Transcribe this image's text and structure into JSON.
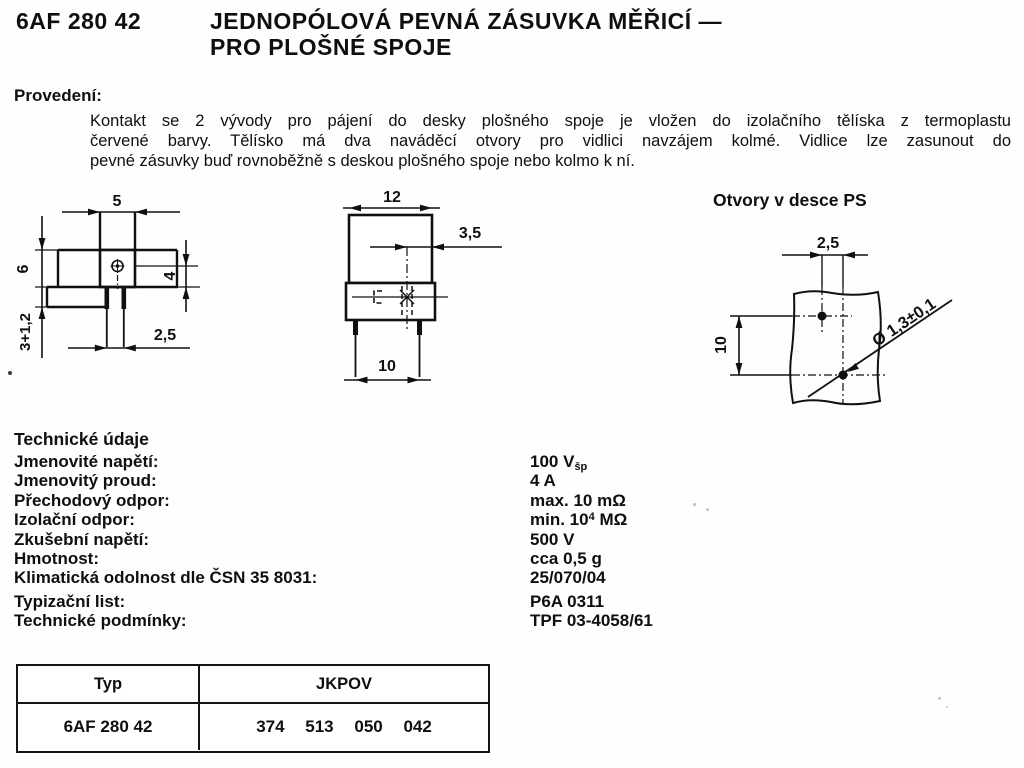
{
  "header": {
    "code": "6AF 280 42",
    "title_line1": "JEDNOPÓLOVÁ PEVNÁ ZÁSUVKA MĚŘICÍ —",
    "title_line2": "PRO PLOŠNÉ SPOJE"
  },
  "provedeni": {
    "heading": "Provedení:",
    "lines": [
      "Kontakt se 2 vývody pro pájení do desky plošného spoje je vložen do izolačního tělíska z termoplastu",
      "červené barvy. Tělísko má dva naváděcí otvory pro vidlici navzájem kolmé. Vidlice lze zasunout do",
      "pevné zásuvky buď rovnoběžně s deskou plošného spoje nebo kolmo k ní."
    ]
  },
  "drawings": {
    "front": {
      "dim_width_top": "5",
      "dim_height": "6",
      "dim_pin_length": "3+1,2",
      "dim_hole_to_base": "4",
      "dim_pin_spacing": "2,5"
    },
    "side": {
      "dim_width": "12",
      "dim_center_to_edge": "3,5",
      "dim_pin_spacing": "10"
    },
    "pcb": {
      "heading": "Otvory v desce PS",
      "dim_hole_spacing_x": "2,5",
      "dim_hole_spacing_y": "10",
      "dim_hole_diameter": "Ø 1,3±0,1"
    }
  },
  "tech": {
    "heading": "Technické údaje",
    "rows": [
      {
        "label": "Jmenovité napětí:",
        "value": "100 V",
        "sub": "šp"
      },
      {
        "label": "Jmenovitý proud:",
        "value": "4 A"
      },
      {
        "label": "Přechodový odpor:",
        "value": "max. 10 mΩ"
      },
      {
        "label": "Izolační odpor:",
        "value": "min. 10",
        "sup": "4",
        "value_after": " MΩ"
      },
      {
        "label": "Zkušební napětí:",
        "value": "500 V"
      },
      {
        "label": "Hmotnost:",
        "value": "cca 0,5 g"
      },
      {
        "label": "Klimatická odolnost dle ČSN 35 8031:",
        "value": "25/070/04"
      },
      {
        "label": "Typizační list:",
        "value": "P6A 0311"
      },
      {
        "label": "Technické podmínky:",
        "value": "TPF 03-4058/61"
      }
    ]
  },
  "table": {
    "headers": [
      "Typ",
      "JKPOV"
    ],
    "row": {
      "typ": "6AF 280 42",
      "jkpov": [
        "374",
        "513",
        "050",
        "042"
      ]
    }
  }
}
